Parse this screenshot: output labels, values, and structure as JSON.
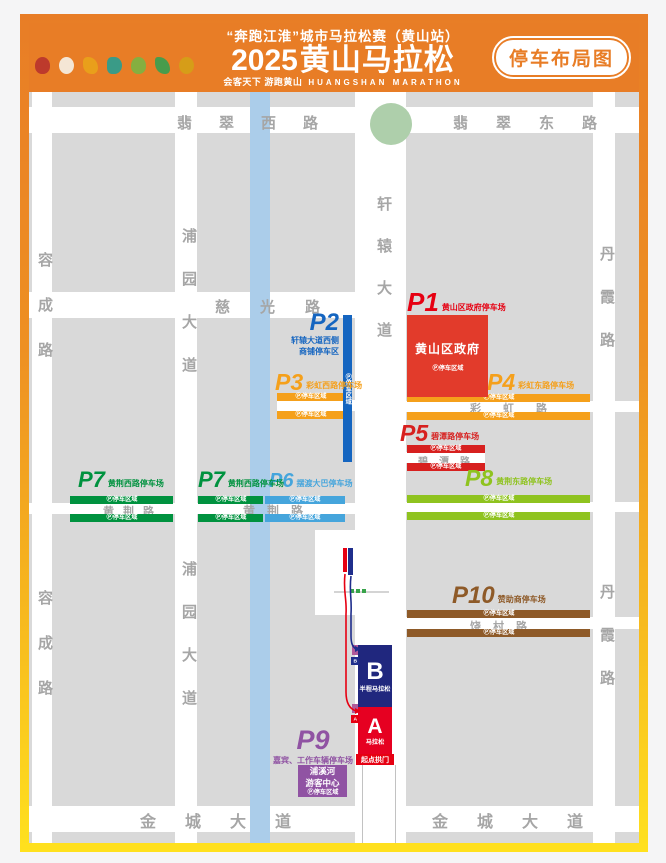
{
  "header": {
    "title_top": "“奔跑江淮”城市马拉松赛（黄山站）",
    "year": "2025",
    "title_main": "黄山马拉松",
    "slogan_cn": "会客天下 游跑黄山",
    "slogan_en": "HUANGSHAN MARATHON",
    "badge": "停车布局图"
  },
  "strings": {
    "zone": "Ⓟ停车区域"
  },
  "roads": {
    "feicui_west": "翡翠西路",
    "feicui_east": "翡翠东路",
    "rongcheng": "容成路",
    "puyuan": "浦园大道",
    "xuanyuan": "轩辕大道",
    "ciguang": "慈光路",
    "danxia": "丹霞路",
    "caihong": "彩虹路",
    "bitan": "碧潭路",
    "huangjing": "黄荆路",
    "raocun": "饶村路",
    "jincheng": "金城大道"
  },
  "parking_lots": {
    "p1": {
      "id": "P1",
      "name": "黄山区政府停车场",
      "color": "#e60012"
    },
    "p2": {
      "id": "P2",
      "name_line1": "轩辕大道西侧",
      "name_line2": "商铺停车区",
      "color": "#1565c0"
    },
    "p3": {
      "id": "P3",
      "name": "彩虹西路停车场",
      "color": "#f5a01b"
    },
    "p4": {
      "id": "P4",
      "name": "彩虹东路停车场",
      "color": "#f5a01b"
    },
    "p5": {
      "id": "P5",
      "name": "碧潭路停车场",
      "color": "#d7201f"
    },
    "p6": {
      "id": "P6",
      "name": "摆渡大巴停车场",
      "color": "#45a5dc"
    },
    "p7": {
      "id": "P7",
      "name": "黄荆西路停车场",
      "color": "#00923f"
    },
    "p8": {
      "id": "P8",
      "name": "黄荆东路停车场",
      "color": "#8fc31f"
    },
    "p9": {
      "id": "P9",
      "name": "嘉宾、工作车辆停车场",
      "color": "#9053a3"
    },
    "p10": {
      "id": "P10",
      "name": "赞助商停车场",
      "color": "#8e5a28"
    }
  },
  "landmarks": {
    "government": {
      "name": "黄山区政府"
    },
    "visitor_center": {
      "line1": "浦溪河",
      "line2": "游客中心"
    },
    "start_arch": "起点拱门",
    "block_b": {
      "letter": "B",
      "label": "半程马拉松"
    },
    "block_a": {
      "letter": "A",
      "label": "马拉松"
    }
  },
  "map_colors": {
    "block": "#d9d9d9",
    "road": "#ffffff",
    "river": "#abcdea",
    "roundabout": "#aecfab",
    "government_red": "#e23b2b",
    "block_a_red": "#e60021",
    "block_b_navy": "#20277e",
    "border_top": "#e87d26",
    "border_bottom": "#ffe11e"
  }
}
